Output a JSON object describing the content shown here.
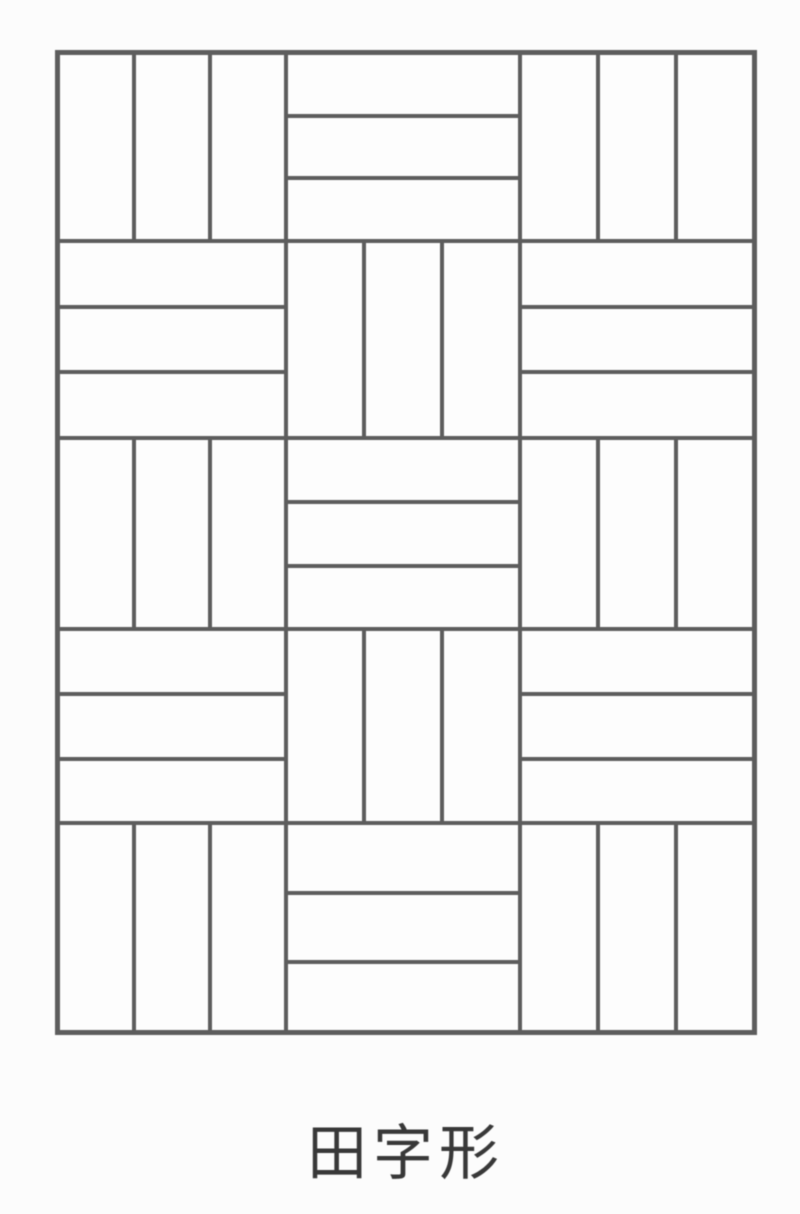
{
  "page": {
    "background": "#fcfcfc"
  },
  "figure": {
    "caption": "田字形",
    "line_color": "#5d5d5d",
    "caption_color": "#383838",
    "grid": {
      "columns": 3,
      "rows": 5,
      "planks_per_cell": 3
    },
    "pattern": [
      [
        "vertical",
        "horizontal",
        "vertical"
      ],
      [
        "horizontal",
        "vertical",
        "horizontal"
      ],
      [
        "vertical",
        "horizontal",
        "vertical"
      ],
      [
        "horizontal",
        "vertical",
        "horizontal"
      ],
      [
        "vertical",
        "horizontal",
        "vertical"
      ]
    ]
  }
}
